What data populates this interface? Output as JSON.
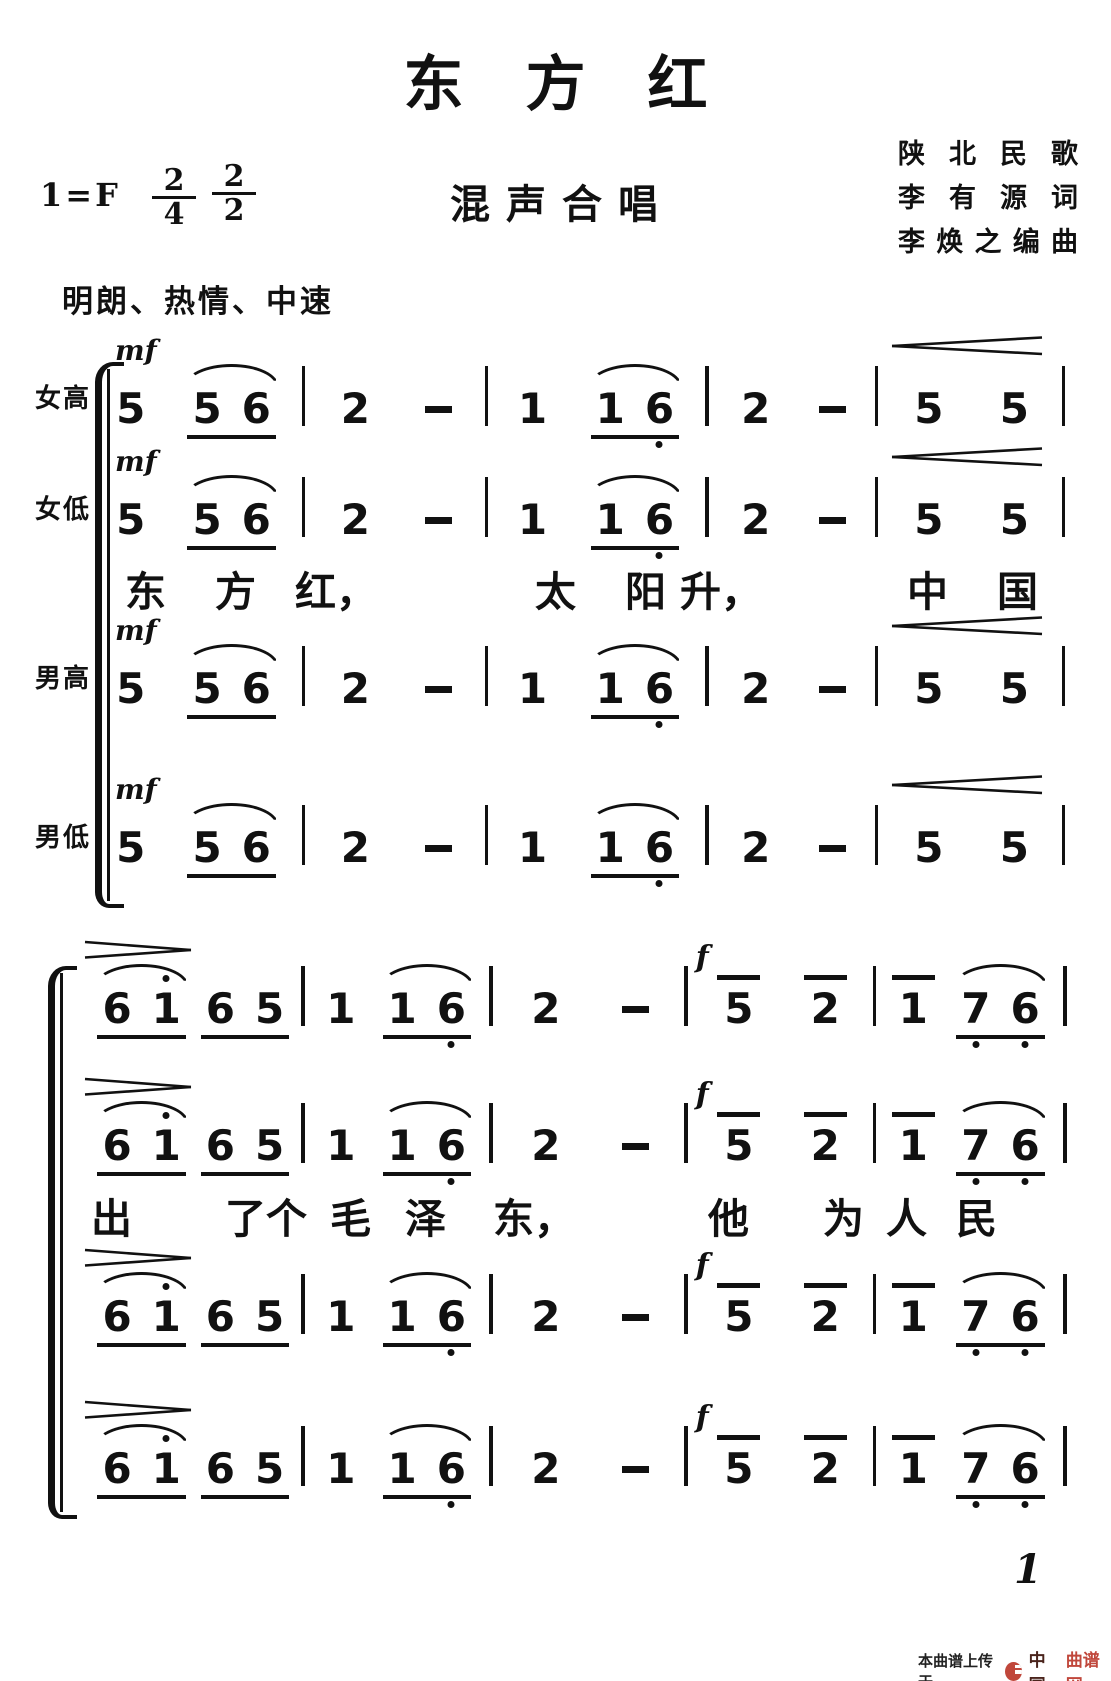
{
  "header": {
    "title": "东方红",
    "key_label": "1=F",
    "time_signatures": [
      {
        "numerator": "2",
        "denominator": "4"
      },
      {
        "numerator": "2",
        "denominator": "2"
      }
    ],
    "subtitle": "混声合唱",
    "credits": [
      "陕北民歌",
      "李有源词",
      "李焕之编曲"
    ],
    "tempo": "明朗、热情、中速"
  },
  "score": {
    "dynamics": {
      "mf": "mf",
      "f": "f"
    },
    "systems": [
      {
        "voices": 4,
        "voice_labels": [
          "女高",
          "女低",
          "男高",
          "男低"
        ],
        "lyrics_after_voice": 2,
        "lyrics": [
          "东",
          "方",
          "红，",
          "太",
          "阳",
          "升，",
          "中",
          "国"
        ],
        "measures": [
          {
            "dynamic": "mf",
            "tokens": [
              {
                "t": "note",
                "v": "5"
              },
              {
                "t": "group",
                "slur": true,
                "notes": [
                  {
                    "v": "5"
                  },
                  {
                    "v": "6"
                  }
                ]
              }
            ]
          },
          {
            "tokens": [
              {
                "t": "note",
                "v": "2"
              },
              {
                "t": "dash"
              }
            ]
          },
          {
            "tokens": [
              {
                "t": "note",
                "v": "1"
              },
              {
                "t": "group",
                "slur": true,
                "notes": [
                  {
                    "v": "1"
                  },
                  {
                    "v": "6",
                    "oct": -1
                  }
                ]
              }
            ]
          },
          {
            "tokens": [
              {
                "t": "note",
                "v": "2"
              },
              {
                "t": "dash"
              }
            ]
          },
          {
            "hairpin": "cresc",
            "tokens": [
              {
                "t": "note",
                "v": "5"
              },
              {
                "t": "note",
                "v": "5"
              }
            ]
          }
        ]
      },
      {
        "voices": 4,
        "voice_labels": [],
        "lyrics_after_voice": 2,
        "lyrics": [
          "出",
          "了个",
          "毛",
          "泽",
          "东，",
          "他",
          "为",
          "人",
          "民"
        ],
        "measures": [
          {
            "hairpin": "dim",
            "tokens": [
              {
                "t": "group",
                "slur": true,
                "notes": [
                  {
                    "v": "6"
                  },
                  {
                    "v": "1",
                    "oct": 1
                  }
                ]
              },
              {
                "t": "group",
                "notes": [
                  {
                    "v": "6"
                  },
                  {
                    "v": "5"
                  }
                ]
              }
            ]
          },
          {
            "tokens": [
              {
                "t": "note",
                "v": "1"
              },
              {
                "t": "group",
                "slur": true,
                "notes": [
                  {
                    "v": "1"
                  },
                  {
                    "v": "6",
                    "oct": -1
                  }
                ]
              }
            ]
          },
          {
            "tokens": [
              {
                "t": "note",
                "v": "2"
              },
              {
                "t": "dash"
              }
            ]
          },
          {
            "dynamic": "f",
            "tokens": [
              {
                "t": "note",
                "v": "5",
                "overline": true
              },
              {
                "t": "note",
                "v": "2",
                "overline": true
              }
            ]
          },
          {
            "tokens": [
              {
                "t": "note",
                "v": "1",
                "overline": true
              },
              {
                "t": "group",
                "slur": true,
                "notes": [
                  {
                    "v": "7",
                    "oct": -1
                  },
                  {
                    "v": "6",
                    "oct": -1
                  }
                ]
              }
            ]
          }
        ]
      }
    ]
  },
  "footer": {
    "page_number": "1",
    "upload_text": "本曲谱上传于",
    "site_dark": "中国",
    "site_red": "曲谱网",
    "colors": {
      "logo": "#c0473b",
      "site_dark": "#4a241c",
      "site_red": "#c0473b"
    }
  }
}
